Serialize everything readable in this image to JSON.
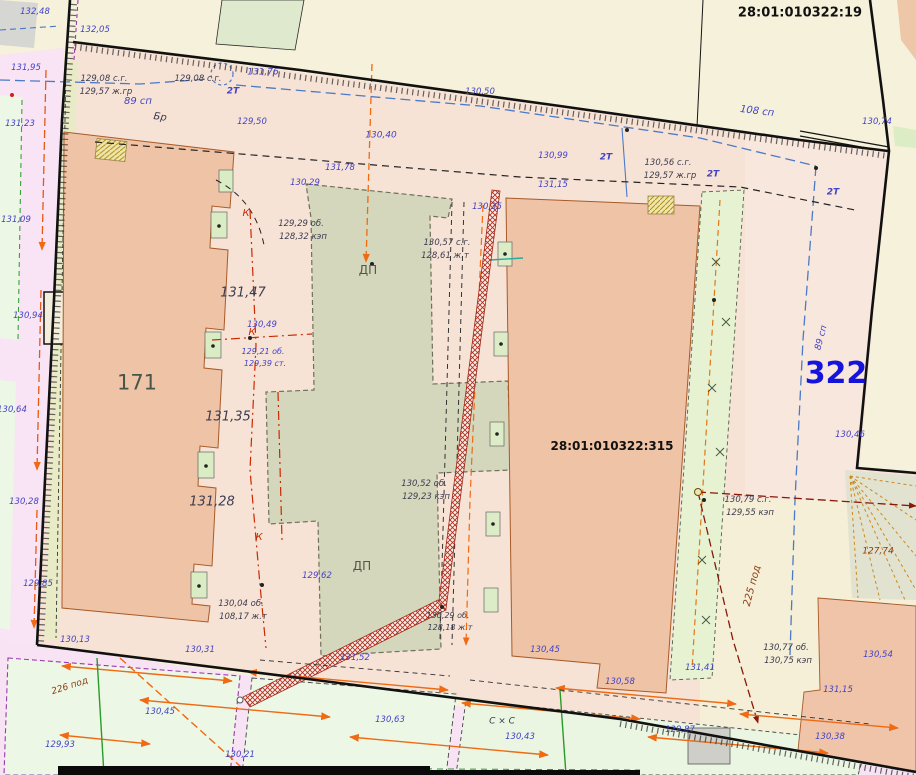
{
  "map": {
    "parcels": {
      "p19": {
        "id": "28:01:010322:19"
      },
      "p315": {
        "id": "28:01:010322:315"
      },
      "p322": {
        "id": "322"
      },
      "b171": {
        "id": "171"
      }
    },
    "colors": {
      "blue": "#4343c6",
      "dark": "#3c3c50",
      "dp": "#565648",
      "red": "#c62a06",
      "brown": "#8d3a10",
      "black": "#151515",
      "bigblue": "#1414dd",
      "bld": "#46564a"
    },
    "labels": [
      {
        "t": "ДП",
        "x": 368,
        "y": 270,
        "c": "dp",
        "s": 12,
        "i": false
      },
      {
        "t": "ДП",
        "x": 362,
        "y": 566,
        "c": "dp",
        "s": 12,
        "i": false
      },
      {
        "t": "131,47",
        "x": 243,
        "y": 293,
        "c": "dark",
        "s": 13
      },
      {
        "t": "131,35",
        "x": 228,
        "y": 417,
        "c": "dark",
        "s": 13
      },
      {
        "t": "131,28",
        "x": 212,
        "y": 502,
        "c": "dark",
        "s": 13
      },
      {
        "t": "131,76",
        "x": 263,
        "y": 73,
        "c": "blue",
        "s": 9
      },
      {
        "t": "130,40",
        "x": 381,
        "y": 136,
        "c": "blue",
        "s": 9
      },
      {
        "t": "108 сп",
        "x": 757,
        "y": 112,
        "c": "blue",
        "s": 10,
        "r": 7
      },
      {
        "t": "89 сп",
        "x": 138,
        "y": 102,
        "c": "blue",
        "s": 10
      },
      {
        "t": "89 сп",
        "x": 822,
        "y": 338,
        "c": "blue",
        "s": 9,
        "r": -75
      },
      {
        "t": "Бр",
        "x": 160,
        "y": 118,
        "c": "dark",
        "s": 10,
        "r": 8
      },
      {
        "t": "2Т",
        "x": 233,
        "y": 92,
        "c": "blue",
        "s": 9,
        "w": 600
      },
      {
        "t": "2Т",
        "x": 606,
        "y": 158,
        "c": "blue",
        "s": 9,
        "w": 600
      },
      {
        "t": "2Т",
        "x": 713,
        "y": 175,
        "c": "blue",
        "s": 9,
        "w": 600
      },
      {
        "t": "2Т",
        "x": 833,
        "y": 193,
        "c": "blue",
        "s": 9,
        "w": 600
      },
      {
        "t": "К",
        "x": 246,
        "y": 214,
        "c": "red",
        "s": 10
      },
      {
        "t": "К",
        "x": 252,
        "y": 333,
        "c": "red",
        "s": 10
      },
      {
        "t": "К",
        "x": 259,
        "y": 538,
        "c": "red",
        "s": 10
      },
      {
        "t": "129,08 с.г.",
        "x": 104,
        "y": 79,
        "c": "dark",
        "s": 8.5
      },
      {
        "t": "129,57 ж.гр",
        "x": 106,
        "y": 92,
        "c": "dark",
        "s": 8.5
      },
      {
        "t": "129,08 с.г.",
        "x": 198,
        "y": 79,
        "c": "dark",
        "s": 8.5
      },
      {
        "t": "130,56 с.г.",
        "x": 668,
        "y": 163,
        "c": "dark",
        "s": 8.5
      },
      {
        "t": "129,57 ж.гр",
        "x": 670,
        "y": 176,
        "c": "dark",
        "s": 8.5
      },
      {
        "t": "130,57 с.г.",
        "x": 447,
        "y": 243,
        "c": "dark",
        "s": 8.5
      },
      {
        "t": "128,61 ж.т",
        "x": 445,
        "y": 256,
        "c": "dark",
        "s": 8.5
      },
      {
        "t": "129,29 об.",
        "x": 301,
        "y": 224,
        "c": "dark",
        "s": 8.5
      },
      {
        "t": "128,32 кэп",
        "x": 303,
        "y": 237,
        "c": "dark",
        "s": 8.5
      },
      {
        "t": "130,52 об.",
        "x": 424,
        "y": 484,
        "c": "dark",
        "s": 8.5
      },
      {
        "t": "129,23 кэп",
        "x": 426,
        "y": 497,
        "c": "dark",
        "s": 8.5
      },
      {
        "t": "130,04 об.",
        "x": 241,
        "y": 604,
        "c": "dark",
        "s": 8.5
      },
      {
        "t": "108,17 ж.т",
        "x": 243,
        "y": 617,
        "c": "dark",
        "s": 8.5
      },
      {
        "t": "130,79 с.г.",
        "x": 748,
        "y": 500,
        "c": "dark",
        "s": 8.5
      },
      {
        "t": "129,55 кэп",
        "x": 750,
        "y": 513,
        "c": "dark",
        "s": 8.5
      },
      {
        "t": "130,77 об.",
        "x": 786,
        "y": 648,
        "c": "dark",
        "s": 8.5
      },
      {
        "t": "130,75 кэп",
        "x": 788,
        "y": 661,
        "c": "dark",
        "s": 8.5
      },
      {
        "t": "130,29 об.",
        "x": 448,
        "y": 616,
        "c": "dark",
        "s": 8
      },
      {
        "t": "128,18 ж.т",
        "x": 450,
        "y": 628,
        "c": "dark",
        "s": 8
      },
      {
        "t": "127,74",
        "x": 878,
        "y": 552,
        "c": "brown",
        "s": 9
      },
      {
        "t": "225 под",
        "x": 753,
        "y": 586,
        "c": "brown",
        "s": 10,
        "r": -75
      },
      {
        "t": "226 под",
        "x": 70,
        "y": 687,
        "c": "brown",
        "s": 9,
        "r": -18
      },
      {
        "t": "С × С",
        "x": 502,
        "y": 722,
        "c": "dark",
        "s": 9
      },
      {
        "t": "132,05",
        "x": 95,
        "y": 30,
        "c": "blue",
        "s": 8.5
      },
      {
        "t": "132,48",
        "x": 35,
        "y": 12,
        "c": "blue",
        "s": 8.5
      },
      {
        "t": "131,95",
        "x": 26,
        "y": 68,
        "c": "blue",
        "s": 8.5
      },
      {
        "t": "131,23",
        "x": 20,
        "y": 124,
        "c": "blue",
        "s": 8.5
      },
      {
        "t": "131,09",
        "x": 16,
        "y": 220,
        "c": "blue",
        "s": 8.5
      },
      {
        "t": "130,94",
        "x": 28,
        "y": 316,
        "c": "blue",
        "s": 8.5
      },
      {
        "t": "130,64",
        "x": 12,
        "y": 410,
        "c": "blue",
        "s": 8.5
      },
      {
        "t": "130,28",
        "x": 24,
        "y": 502,
        "c": "blue",
        "s": 8.5
      },
      {
        "t": "129,85",
        "x": 38,
        "y": 584,
        "c": "blue",
        "s": 8.5
      },
      {
        "t": "129,50",
        "x": 252,
        "y": 122,
        "c": "blue",
        "s": 8.5
      },
      {
        "t": "130,29",
        "x": 305,
        "y": 183,
        "c": "blue",
        "s": 8.5
      },
      {
        "t": "131,78",
        "x": 340,
        "y": 168,
        "c": "blue",
        "s": 8.5
      },
      {
        "t": "130,50",
        "x": 480,
        "y": 92,
        "c": "blue",
        "s": 8.5
      },
      {
        "t": "130,99",
        "x": 553,
        "y": 156,
        "c": "blue",
        "s": 8.5
      },
      {
        "t": "131,15",
        "x": 553,
        "y": 185,
        "c": "blue",
        "s": 8.5
      },
      {
        "t": "130,35",
        "x": 487,
        "y": 207,
        "c": "blue",
        "s": 8.5
      },
      {
        "t": "130,49",
        "x": 262,
        "y": 325,
        "c": "blue",
        "s": 8.5
      },
      {
        "t": "129,21 об.",
        "x": 263,
        "y": 352,
        "c": "blue",
        "s": 8
      },
      {
        "t": "129,39 ст.",
        "x": 265,
        "y": 364,
        "c": "blue",
        "s": 8
      },
      {
        "t": "129,62",
        "x": 317,
        "y": 576,
        "c": "blue",
        "s": 8.5
      },
      {
        "t": "130,46",
        "x": 850,
        "y": 435,
        "c": "blue",
        "s": 8.5
      },
      {
        "t": "130,74",
        "x": 877,
        "y": 122,
        "c": "blue",
        "s": 8.5
      },
      {
        "t": "130,13",
        "x": 75,
        "y": 640,
        "c": "blue",
        "s": 8.5
      },
      {
        "t": "130,31",
        "x": 200,
        "y": 650,
        "c": "blue",
        "s": 8.5
      },
      {
        "t": "131,52",
        "x": 355,
        "y": 658,
        "c": "blue",
        "s": 8.5
      },
      {
        "t": "130,45",
        "x": 545,
        "y": 650,
        "c": "blue",
        "s": 8.5
      },
      {
        "t": "130,58",
        "x": 620,
        "y": 682,
        "c": "blue",
        "s": 8.5
      },
      {
        "t": "131,41",
        "x": 700,
        "y": 668,
        "c": "blue",
        "s": 8.5
      },
      {
        "t": "131,15",
        "x": 838,
        "y": 690,
        "c": "blue",
        "s": 8.5
      },
      {
        "t": "130,54",
        "x": 878,
        "y": 655,
        "c": "blue",
        "s": 8.5
      },
      {
        "t": "130,45",
        "x": 160,
        "y": 712,
        "c": "blue",
        "s": 8.5
      },
      {
        "t": "130,63",
        "x": 390,
        "y": 720,
        "c": "blue",
        "s": 8.5
      },
      {
        "t": "130,43",
        "x": 520,
        "y": 737,
        "c": "blue",
        "s": 8.5
      },
      {
        "t": "129,87",
        "x": 680,
        "y": 730,
        "c": "blue",
        "s": 8.5
      },
      {
        "t": "130,38",
        "x": 830,
        "y": 737,
        "c": "blue",
        "s": 8.5
      },
      {
        "t": "129,93",
        "x": 60,
        "y": 745,
        "c": "blue",
        "s": 8.5
      },
      {
        "t": "130,21",
        "x": 240,
        "y": 755,
        "c": "blue",
        "s": 8.5
      }
    ]
  }
}
